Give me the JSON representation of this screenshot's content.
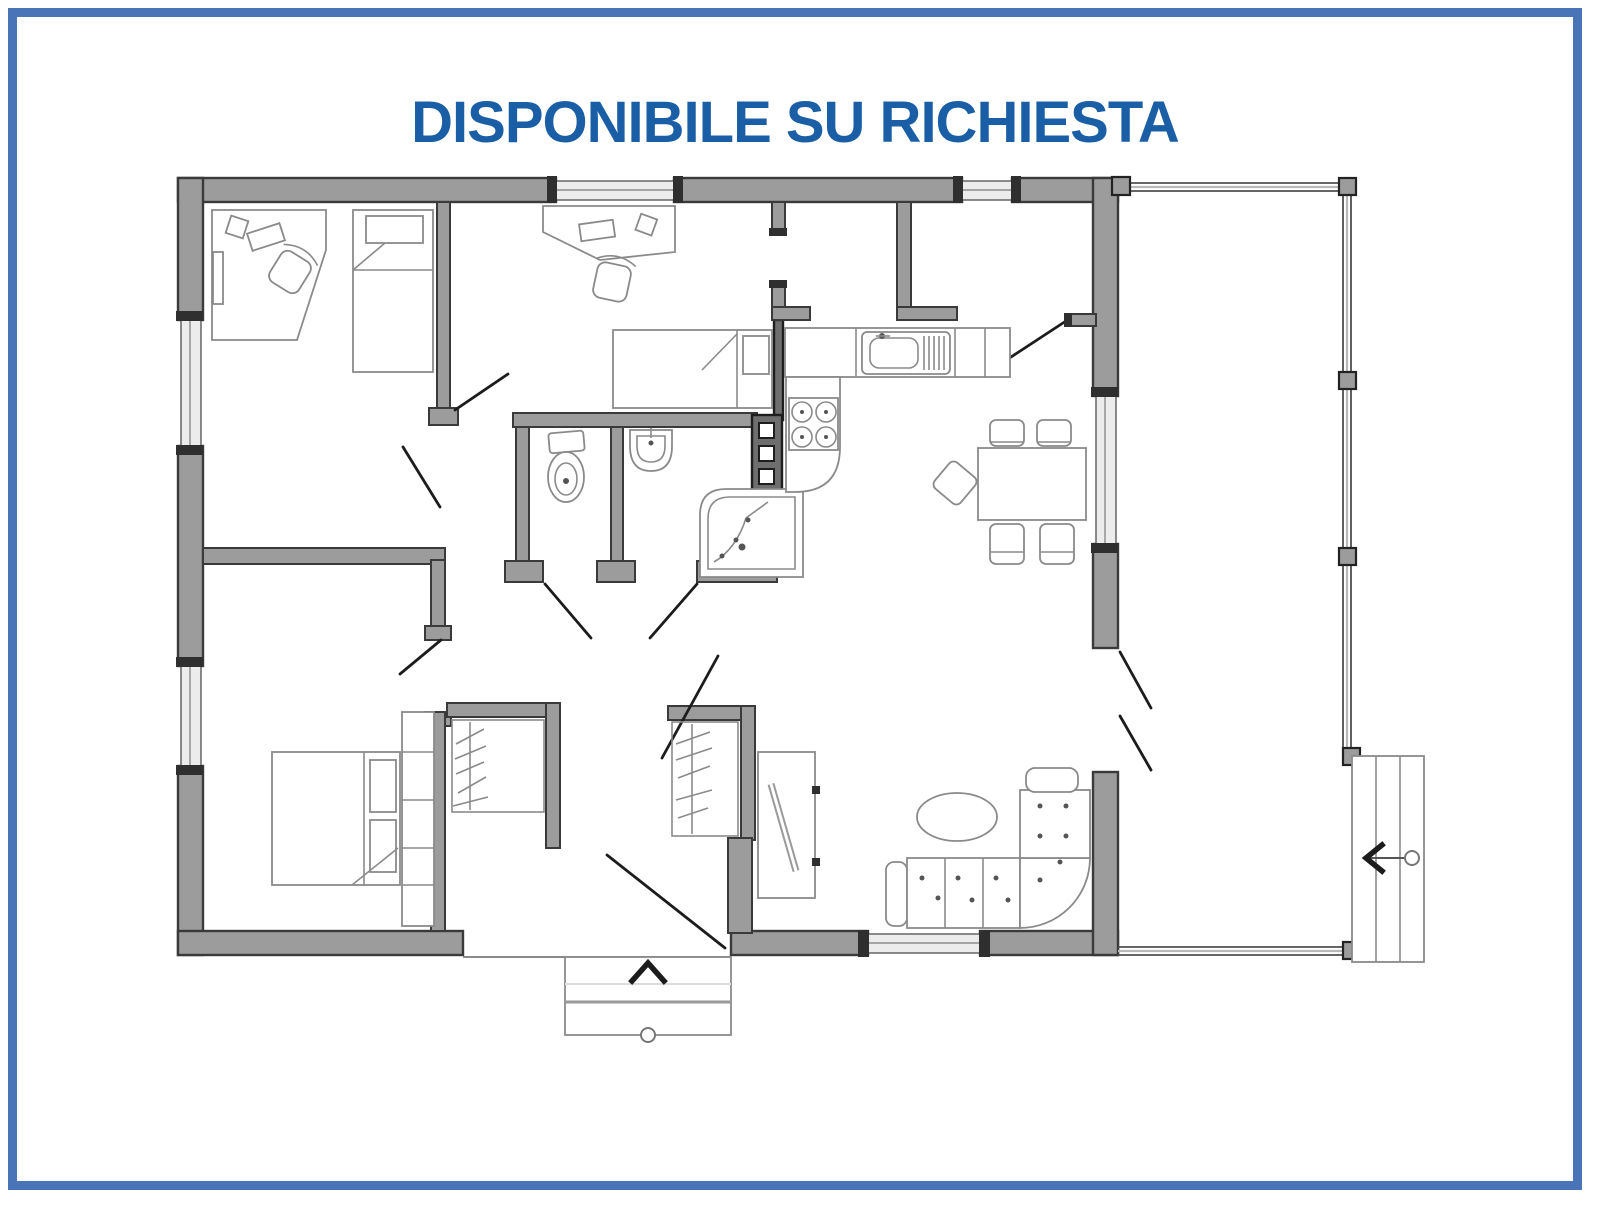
{
  "title": {
    "text": "DISPONIBILE SU RICHIESTA",
    "color": "#1a5fa6"
  },
  "frame": {
    "border_color": "#4a74b8",
    "background": "#ffffff"
  },
  "floor_plan": {
    "palette": {
      "wall_fill": "#9c9c9c",
      "wall_outline": "#3a3a3a",
      "appliance_column_fill": "#6e6e6e",
      "furniture_line": "#8a8a8a",
      "window_fill": "#ececec",
      "door_line": "#1c1c1c",
      "deck_line": "#4f4f4f"
    },
    "rooms": [
      {
        "name": "bedroom-office-top-left",
        "furniture": [
          "corner-desk",
          "monitor",
          "office-chair",
          "pc-tower",
          "single-bed"
        ]
      },
      {
        "name": "bedroom-top-middle",
        "furniture": [
          "desk",
          "monitor",
          "office-chair",
          "single-bed"
        ]
      },
      {
        "name": "storage-room",
        "furniture": []
      },
      {
        "name": "wc",
        "furniture": [
          "toilet"
        ]
      },
      {
        "name": "bathroom",
        "furniture": [
          "washbasin",
          "corner-shower",
          "service-column"
        ]
      },
      {
        "name": "kitchen",
        "furniture": [
          "counter",
          "kitchen-sink",
          "drainer",
          "cooktop-4-burners"
        ]
      },
      {
        "name": "dining-area",
        "furniture": [
          "dining-table",
          "chair",
          "chair",
          "chair",
          "chair",
          "chair"
        ]
      },
      {
        "name": "living-room",
        "furniture": [
          "corner-sofa",
          "oval-coffee-table",
          "tv-unit"
        ]
      },
      {
        "name": "bedroom-bottom-left",
        "furniture": [
          "double-bed",
          "pillows",
          "headboard-cabinets",
          "nightstand",
          "nightstand"
        ]
      },
      {
        "name": "walk-in-closet-left",
        "furniture": [
          "clothes-rail-with-hangers"
        ]
      },
      {
        "name": "walk-in-closet-right",
        "furniture": [
          "clothes-rail-with-hangers"
        ]
      },
      {
        "name": "hallway",
        "furniture": []
      },
      {
        "name": "terrace",
        "furniture": [
          "railing-posts"
        ]
      }
    ],
    "features": {
      "windows_count": 6,
      "interior_doors_count": 8,
      "entrance_steps": {
        "location": "bottom-center",
        "direction_arrow": "up"
      },
      "terrace_steps": {
        "location": "right",
        "direction_arrow": "left"
      },
      "terrace_double_door": {
        "location": "right-wall"
      }
    }
  }
}
